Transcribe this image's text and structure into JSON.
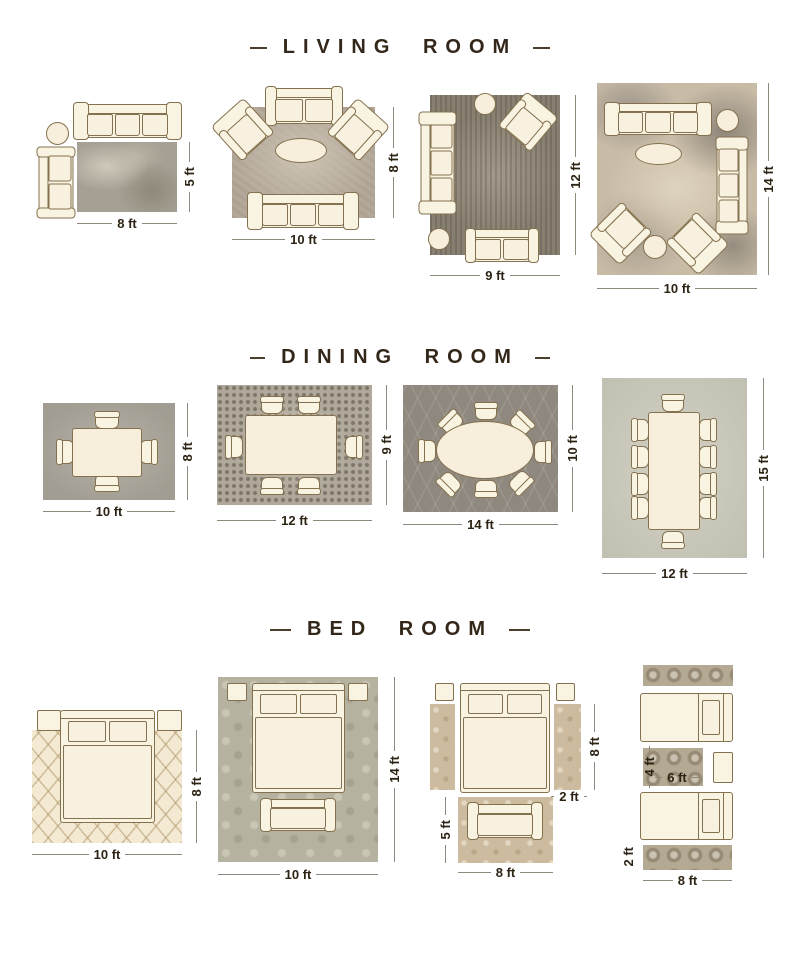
{
  "colors": {
    "background": "#ffffff",
    "heading_text": "#33271a",
    "dimension_text": "#2d2314",
    "dimension_line": "#8f887d",
    "furniture_fill": "#f9f3e2",
    "furniture_outline": "#84714f"
  },
  "sections": [
    {
      "title": "LIVING ROOM",
      "layouts": [
        {
          "labels": {
            "w": "8 ft",
            "h": "5 ft"
          }
        },
        {
          "labels": {
            "w": "10 ft",
            "h": "8 ft"
          }
        },
        {
          "labels": {
            "w": "9 ft",
            "h": "12 ft"
          }
        },
        {
          "labels": {
            "w": "10 ft",
            "h": "14 ft"
          }
        }
      ]
    },
    {
      "title": "DINING ROOM",
      "layouts": [
        {
          "labels": {
            "w": "10 ft",
            "h": "8 ft"
          }
        },
        {
          "labels": {
            "w": "12 ft",
            "h": "9 ft"
          }
        },
        {
          "labels": {
            "w": "14 ft",
            "h": "10 ft"
          }
        },
        {
          "labels": {
            "w": "12 ft",
            "h": "15 ft"
          }
        }
      ]
    },
    {
      "title": "BED ROOM",
      "layouts": [
        {
          "labels": {
            "w": "10 ft",
            "h": "8 ft"
          }
        },
        {
          "labels": {
            "w": "10 ft",
            "h": "14 ft"
          }
        },
        {
          "labels": {
            "runner_h": "8 ft",
            "runner_w": "2 ft",
            "foot_h": "5 ft",
            "foot_w": "8 ft"
          }
        },
        {
          "labels": {
            "mid_h": "4 ft",
            "mid_w": "6 ft",
            "runner_side": "2 ft",
            "runner_w": "8 ft"
          }
        }
      ]
    }
  ]
}
